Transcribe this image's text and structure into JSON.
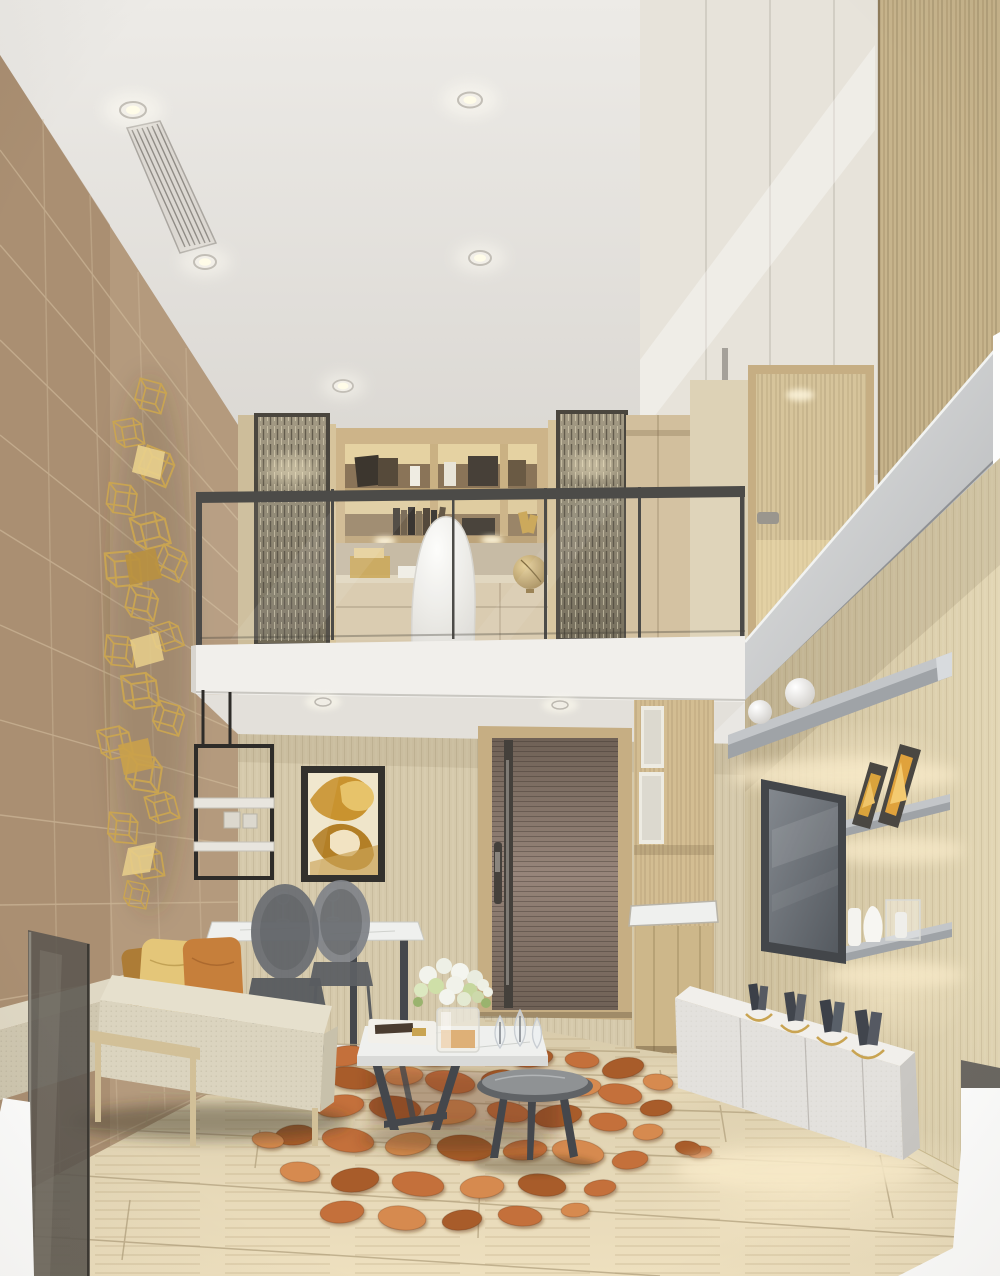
{
  "scene": {
    "description": "Photorealistic interior rendering of a double-height duplex loft apartment: living room below with beige sofa, orange pebble rug, marble coffee tables, dining set, abstract gold artwork, entry door, kitchenette, TV wall with lit floating shelves and floating white console; mezzanine study above with glass balustrade, textured screen panels, shelving, white desk chair and globe; gold wireframe wall sculpture on tan tiled wall; recessed ceiling downlights and linear air vent.",
    "objects": [
      "ceiling-downlights",
      "air-vent",
      "gold-wall-sculpture",
      "tiled-accent-wall",
      "mezzanine-study",
      "glass-balustrade",
      "screen-panels",
      "bookshelf",
      "desk-chair",
      "globe",
      "stair-balustrade",
      "upper-door",
      "entry-door",
      "kitchenette",
      "abstract-artwork",
      "hanging-shelf",
      "dining-table",
      "ghost-chairs",
      "wine-glasses",
      "sofa",
      "cushions",
      "pebble-rug",
      "coffee-tables",
      "flower-vase",
      "crystal-decor",
      "tv",
      "floating-shelves",
      "picture-frames",
      "white-vases",
      "tv-console",
      "book-stands",
      "travertine-floor"
    ]
  },
  "palette": {
    "ceiling_a": "#edebe7",
    "ceiling_b": "#dad7d2",
    "tile_wall": "#b49a7d",
    "tile_dark": "#a2876a",
    "tile_grout": "#d2bd9e",
    "back_wall": "#d5c9ab",
    "right_wall_a": "#cdbf9c",
    "right_wall_b": "#e2d6b4",
    "wood_column": "#c7b48c",
    "corridor": "#ddd2b6",
    "cabinet_white": "#e7e3da",
    "band_a": "#e4e5e5",
    "band_b": "#b2b4b6",
    "rail_metal": "#4c4b48",
    "fascia": "#f1efeb",
    "soffit": "#e3e0da",
    "screen_a": "#a49b85",
    "screen_b": "#6f6855",
    "screen_frame": "#4a463e",
    "shelf_wood": "#cdb489",
    "niche_glow": "#f5e3af",
    "niche_dark": "#8a7458",
    "desk_chair": "#f3f2ee",
    "globe_a": "#e6cf96",
    "globe_b": "#8f7340",
    "door_wood_a": "#97857a",
    "door_wood_b": "#6f6156",
    "door_frame": "#c6ae83",
    "door_metal": "#44403b",
    "kitchen_wood": "#d3bd92",
    "art_frame": "#33312d",
    "art_bg": "#efe5ca",
    "art_gold": "#c9932f",
    "art_gold_light": "#e7c36a",
    "sculpt_gold": "#c9a452",
    "sculpt_gold_light": "#e9d08c",
    "marble": "#eff0ee",
    "marble_edge": "#d9dad8",
    "table_leg": "#44474c",
    "chair_gray": "#6e7175",
    "chair_gray_light": "#82858a",
    "sofa_top": "#e6e0cd",
    "sofa_front": "#dbd4bf",
    "sofa_side": "#c8c1ab",
    "bench_top": "#dfd8c4",
    "bench_front": "#cfc7b0",
    "sofa_wood": "#d2c098",
    "pillow_bronze": "#ad7c36",
    "pillow_gold": "#e4c679",
    "pillow_orange": "#c67f3b",
    "rug_1": "#c4703a",
    "rug_2": "#a85c2b",
    "rug_3": "#d68a50",
    "floor_a": "#d8cbab",
    "floor_b": "#eee0bf",
    "floor_grout": "#b3a27f",
    "baseboard": "#e9ddbe",
    "tv_frame": "#43464a",
    "tv_a": "#83888e",
    "tv_b": "#555a60",
    "shelf_silver": "#c3c6c9",
    "shelf_silver_dark": "#9fa3a7",
    "console_white": "#f1efeb",
    "console_front": "#e3e1dd",
    "console_side": "#c9c7c3",
    "glow_warm": "#f7e9c8",
    "dark_glass": "#5b5750",
    "white_cut": "#fdfdfc"
  }
}
